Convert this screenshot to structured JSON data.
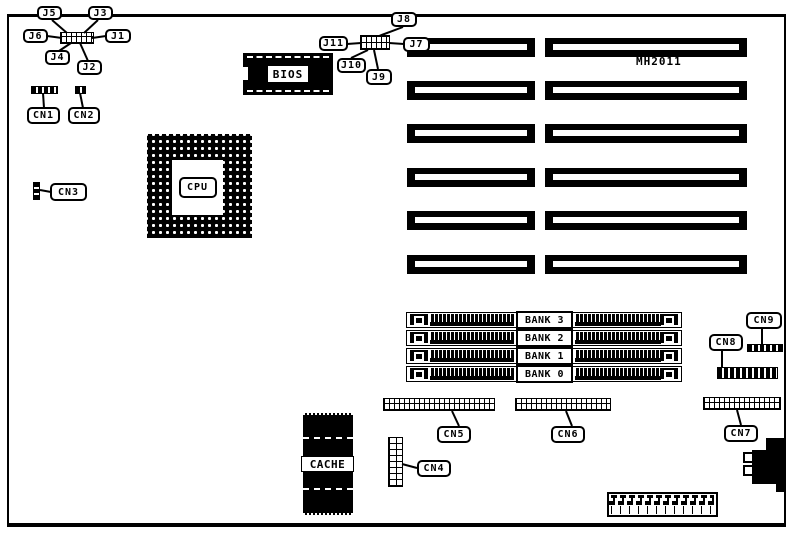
{
  "board": {
    "model": "MH2011"
  },
  "chips": {
    "cpu": "CPU",
    "bios": "BIOS",
    "cache": "CACHE"
  },
  "jumpers": {
    "J1": "J1",
    "J2": "J2",
    "J3": "J3",
    "J4": "J4",
    "J5": "J5",
    "J6": "J6",
    "J7": "J7",
    "J8": "J8",
    "J9": "J9",
    "J10": "J10",
    "J11": "J11"
  },
  "connectors": {
    "CN1": "CN1",
    "CN2": "CN2",
    "CN3": "CN3",
    "CN4": "CN4",
    "CN5": "CN5",
    "CN6": "CN6",
    "CN7": "CN7",
    "CN8": "CN8",
    "CN9": "CN9"
  },
  "memory_banks": [
    "BANK 3",
    "BANK 2",
    "BANK 1",
    "BANK 0"
  ]
}
